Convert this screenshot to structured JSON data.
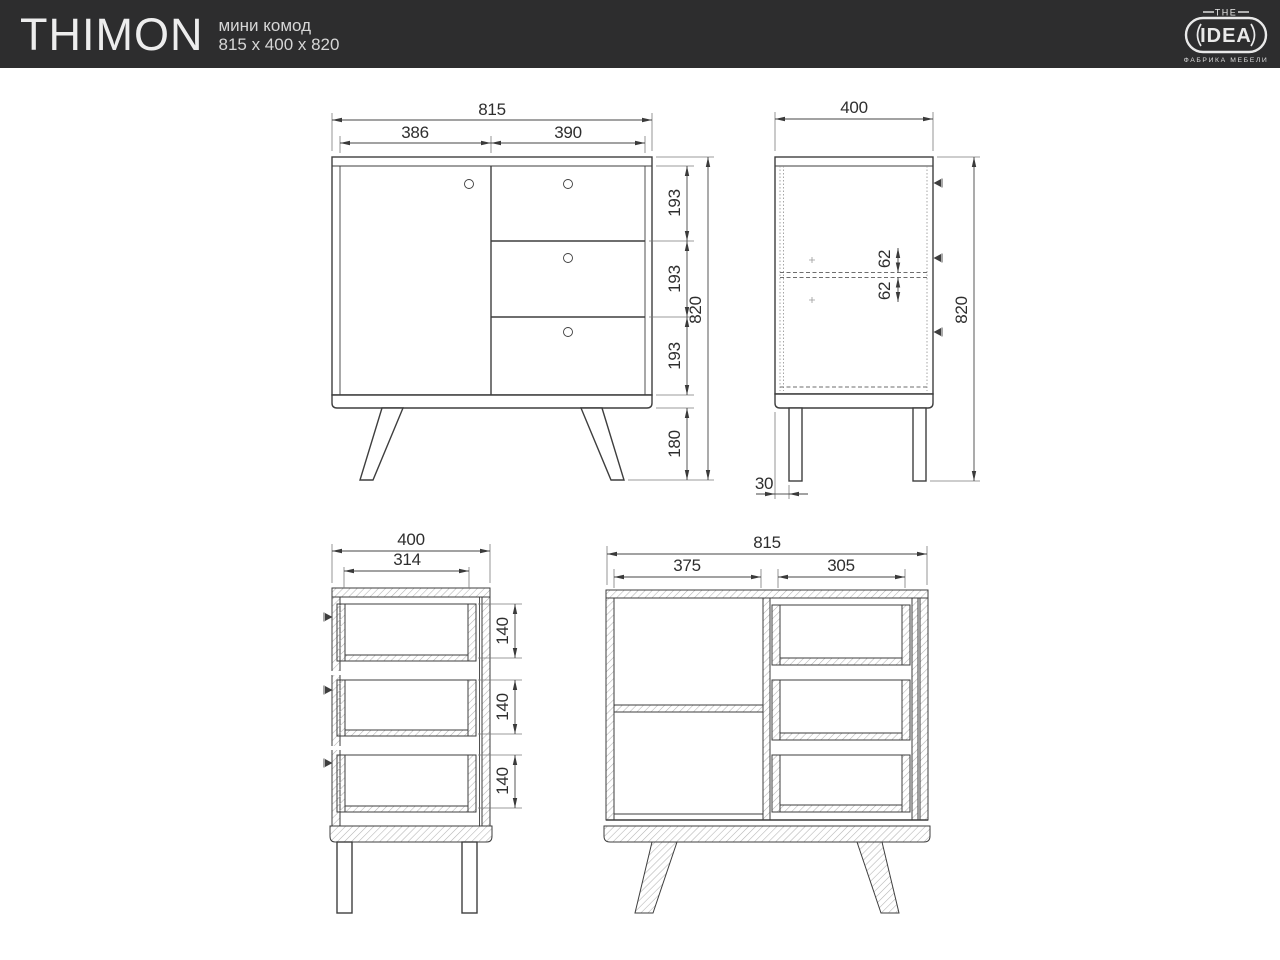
{
  "header": {
    "title": "THIMON",
    "subtitle": {
      "line1": "мини комод",
      "line2": "815 x 400 x 820"
    },
    "logo": {
      "top": "THE",
      "name": "IDEA",
      "tagline": "ФАБРИКА МЕБЕЛИ"
    },
    "colors": {
      "bar_bg": "#2d2d2e",
      "bar_text": "#ededed"
    }
  },
  "drawing": {
    "line_color": "#3e3e3e",
    "views": {
      "front": {
        "dims": {
          "total_width": "815",
          "door_width": "386",
          "drawer_front_width": "390",
          "drawer_heights": [
            "193",
            "193",
            "193"
          ],
          "leg_height": "180",
          "total_height": "820"
        }
      },
      "side": {
        "dims": {
          "total_depth": "400",
          "total_height": "820",
          "shelf_offsets": [
            "62",
            "62"
          ],
          "leg_front_offset": "30"
        }
      },
      "side_section": {
        "dims": {
          "total_depth": "400",
          "drawer_depth": "314",
          "drawer_box_heights": [
            "140",
            "140",
            "140"
          ]
        }
      },
      "front_section": {
        "dims": {
          "total_width": "815",
          "compartment_inner_width": "375",
          "drawer_box_width": "305"
        }
      }
    }
  }
}
